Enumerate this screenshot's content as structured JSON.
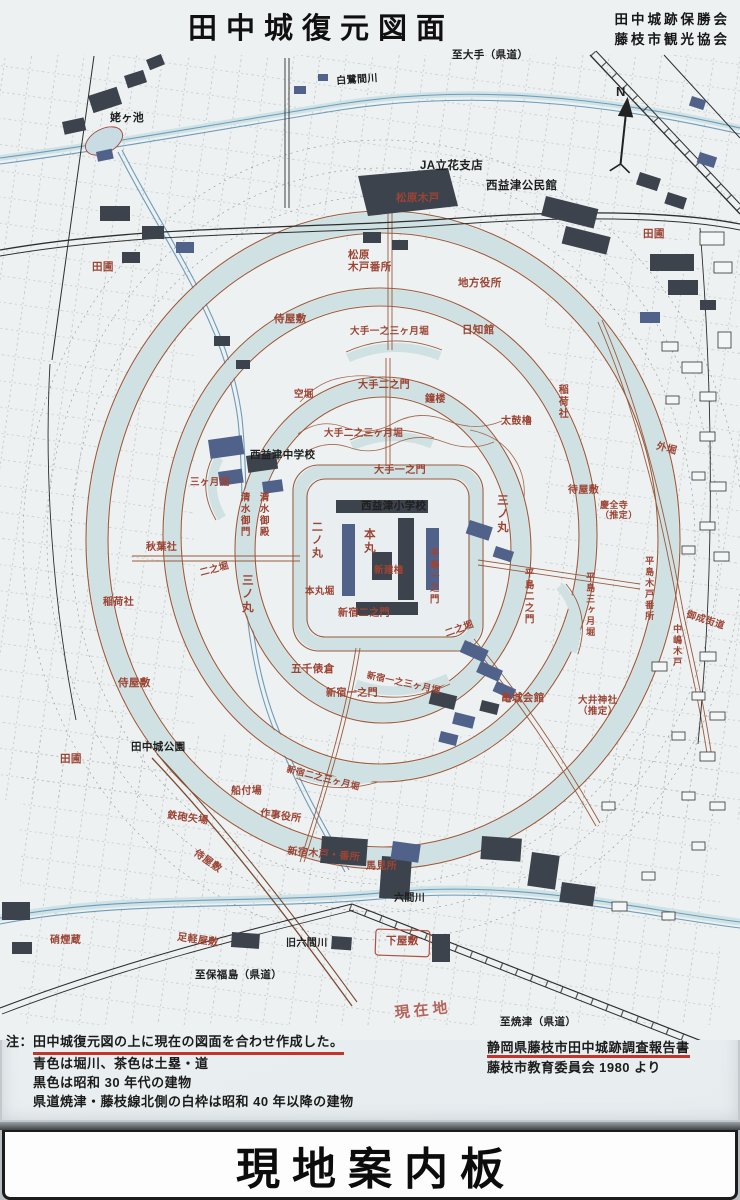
{
  "header": {
    "title": "田中城復元図面",
    "org1": "田中城跡保勝会",
    "org2": "藤枝市観光協会"
  },
  "compass": {
    "label": "N"
  },
  "palette": {
    "sign_background": "#edf1f2",
    "moat_water": "#cfe1e2",
    "earthwork_road_brown": "#9b5a3c",
    "red_label": "#9c4434",
    "black_label": "#1e1e1e",
    "building_dark": "#3d434c",
    "building_navy": "#51628a",
    "red_underline": "#c3342a",
    "handwriting_red": "#b0574c"
  },
  "map": {
    "labels": [
      {
        "t": "姥ヶ池",
        "x": 110,
        "y": 112,
        "c": "k",
        "s": 11
      },
      {
        "t": "白鷺間川",
        "x": 336,
        "y": 76,
        "c": "k",
        "s": 10,
        "r": -4
      },
      {
        "t": "至大手（県道）",
        "x": 452,
        "y": 50,
        "c": "k",
        "s": 10.5
      },
      {
        "t": "JA立花支店",
        "x": 420,
        "y": 160,
        "c": "k",
        "s": 11.5
      },
      {
        "t": "西益津公民館",
        "x": 486,
        "y": 180,
        "c": "k",
        "s": 11.5
      },
      {
        "t": "松原木戸",
        "x": 396,
        "y": 193,
        "c": "r",
        "s": 10.5
      },
      {
        "t": "松原\n木戸番所",
        "x": 348,
        "y": 250,
        "c": "r",
        "s": 10.5
      },
      {
        "t": "地方役所",
        "x": 458,
        "y": 278,
        "c": "r",
        "s": 10.5
      },
      {
        "t": "日知館",
        "x": 462,
        "y": 325,
        "c": "r",
        "s": 10.5
      },
      {
        "t": "侍屋敷",
        "x": 274,
        "y": 314,
        "c": "r",
        "s": 10.5
      },
      {
        "t": "田圃",
        "x": 92,
        "y": 262,
        "c": "r",
        "s": 10.5
      },
      {
        "t": "田圃",
        "x": 643,
        "y": 229,
        "c": "r",
        "s": 10.5
      },
      {
        "t": "大手一之三ヶ月堀",
        "x": 350,
        "y": 327,
        "c": "r",
        "s": 9.5
      },
      {
        "t": "空堀",
        "x": 294,
        "y": 390,
        "c": "r",
        "s": 9.5
      },
      {
        "t": "大手二之門",
        "x": 358,
        "y": 380,
        "c": "r",
        "s": 10
      },
      {
        "t": "鐘楼",
        "x": 425,
        "y": 394,
        "c": "r",
        "s": 10
      },
      {
        "t": "大手二之三ヶ月堀",
        "x": 324,
        "y": 429,
        "c": "r",
        "s": 9.5
      },
      {
        "t": "大手一之門",
        "x": 374,
        "y": 465,
        "c": "r",
        "s": 10
      },
      {
        "t": "稲荷社",
        "x": 556,
        "y": 384,
        "c": "r",
        "s": 10,
        "v": 1
      },
      {
        "t": "太鼓櫓",
        "x": 501,
        "y": 416,
        "c": "r",
        "s": 10
      },
      {
        "t": "外堀",
        "x": 658,
        "y": 441,
        "c": "r",
        "s": 10,
        "r": 15
      },
      {
        "t": "三ヶ月堀",
        "x": 190,
        "y": 478,
        "c": "r",
        "s": 9.5
      },
      {
        "t": "清水御門",
        "x": 238,
        "y": 492,
        "c": "r",
        "s": 9.5,
        "v": 1
      },
      {
        "t": "清水御殿",
        "x": 257,
        "y": 492,
        "c": "r",
        "s": 9.5,
        "v": 1
      },
      {
        "t": "西益津中学校",
        "x": 250,
        "y": 450,
        "c": "k",
        "s": 10.5
      },
      {
        "t": "西益津小学校",
        "x": 361,
        "y": 501,
        "c": "k",
        "s": 10.5
      },
      {
        "t": "三ノ丸",
        "x": 495,
        "y": 494,
        "c": "r",
        "s": 11.5,
        "v": 1
      },
      {
        "t": "二ノ丸",
        "x": 310,
        "y": 521,
        "c": "r",
        "s": 11,
        "v": 1
      },
      {
        "t": "本丸",
        "x": 362,
        "y": 528,
        "c": "r",
        "s": 11.5,
        "v": 1
      },
      {
        "t": "新建櫓",
        "x": 374,
        "y": 566,
        "c": "r",
        "s": 9.5
      },
      {
        "t": "待屋敷",
        "x": 568,
        "y": 485,
        "c": "r",
        "s": 10
      },
      {
        "t": "慶全寺\n（推定）",
        "x": 600,
        "y": 500,
        "c": "r",
        "s": 9
      },
      {
        "t": "平島一之門",
        "x": 427,
        "y": 548,
        "c": "r",
        "s": 9.5,
        "v": 1
      },
      {
        "t": "平島二之門",
        "x": 522,
        "y": 568,
        "c": "r",
        "s": 9.5,
        "v": 1
      },
      {
        "t": "平島三ヶ月堀",
        "x": 585,
        "y": 572,
        "c": "r",
        "s": 9,
        "v": 1
      },
      {
        "t": "平島木戸番所",
        "x": 644,
        "y": 556,
        "c": "r",
        "s": 9,
        "v": 1
      },
      {
        "t": "中嶋木戸",
        "x": 672,
        "y": 624,
        "c": "r",
        "s": 9,
        "v": 1
      },
      {
        "t": "御成街道",
        "x": 688,
        "y": 610,
        "c": "r",
        "s": 9.5,
        "r": 18
      },
      {
        "t": "秋葉社",
        "x": 146,
        "y": 542,
        "c": "r",
        "s": 10
      },
      {
        "t": "二之堀",
        "x": 199,
        "y": 569,
        "c": "r",
        "s": 9.5,
        "r": -15
      },
      {
        "t": "三ノ丸",
        "x": 240,
        "y": 574,
        "c": "r",
        "s": 11.5,
        "v": 1
      },
      {
        "t": "稲荷社",
        "x": 103,
        "y": 597,
        "c": "r",
        "s": 10
      },
      {
        "t": "本丸堀",
        "x": 305,
        "y": 587,
        "c": "r",
        "s": 9.5
      },
      {
        "t": "新宿二之門",
        "x": 338,
        "y": 608,
        "c": "r",
        "s": 10
      },
      {
        "t": "二之堀",
        "x": 444,
        "y": 630,
        "c": "r",
        "s": 9.5,
        "r": -20
      },
      {
        "t": "五千俵倉",
        "x": 291,
        "y": 664,
        "c": "r",
        "s": 10.5
      },
      {
        "t": "新宿一之三ヶ月堀",
        "x": 368,
        "y": 670,
        "c": "r",
        "s": 9,
        "r": 12
      },
      {
        "t": "新宿一之門",
        "x": 326,
        "y": 688,
        "c": "r",
        "s": 10
      },
      {
        "t": "亀城会館",
        "x": 501,
        "y": 693,
        "c": "r",
        "s": 10.5
      },
      {
        "t": "大井神社\n（推定）",
        "x": 578,
        "y": 696,
        "c": "r",
        "s": 9.5
      },
      {
        "t": "侍屋敷",
        "x": 118,
        "y": 678,
        "c": "r",
        "s": 10.5
      },
      {
        "t": "田圃",
        "x": 60,
        "y": 754,
        "c": "r",
        "s": 10.5
      },
      {
        "t": "田中城公園",
        "x": 131,
        "y": 742,
        "c": "k",
        "s": 10.5
      },
      {
        "t": "新宿二之三ヶ月堀",
        "x": 288,
        "y": 764,
        "c": "r",
        "s": 9,
        "r": 14
      },
      {
        "t": "船付場",
        "x": 231,
        "y": 786,
        "c": "r",
        "s": 10
      },
      {
        "t": "作事役所",
        "x": 261,
        "y": 808,
        "c": "r",
        "s": 10,
        "r": 8
      },
      {
        "t": "鉄砲矢場",
        "x": 168,
        "y": 810,
        "c": "r",
        "s": 10,
        "r": 8
      },
      {
        "t": "新宿木戸・番所",
        "x": 288,
        "y": 846,
        "c": "r",
        "s": 10,
        "r": 5
      },
      {
        "t": "馬見所",
        "x": 366,
        "y": 861,
        "c": "r",
        "s": 10
      },
      {
        "t": "侍屋敷",
        "x": 198,
        "y": 848,
        "c": "r",
        "s": 10,
        "r": 35
      },
      {
        "t": "足軽屋敷",
        "x": 178,
        "y": 932,
        "c": "r",
        "s": 10,
        "r": 8
      },
      {
        "t": "下屋敷",
        "x": 386,
        "y": 936,
        "c": "r",
        "s": 10.5
      },
      {
        "t": "硝煙蔵",
        "x": 50,
        "y": 935,
        "c": "r",
        "s": 10
      },
      {
        "t": "六間川",
        "x": 394,
        "y": 893,
        "c": "k",
        "s": 10
      },
      {
        "t": "旧六間川",
        "x": 286,
        "y": 938,
        "c": "k",
        "s": 10
      },
      {
        "t": "至保福島（県道）",
        "x": 195,
        "y": 970,
        "c": "k",
        "s": 10.5
      },
      {
        "t": "至焼津（県道）",
        "x": 500,
        "y": 1017,
        "c": "k",
        "s": 10.5
      },
      {
        "t": "現在地",
        "x": 394,
        "y": 1006,
        "c": "h",
        "s": 15,
        "r": -6
      }
    ]
  },
  "notes": {
    "prefix": "注：",
    "line1": "田中城復元図の上に現在の図面を合わせ作成した。",
    "line2": "青色は堀川、茶色は土塁・道",
    "line3": "黒色は昭和 30 年代の建物",
    "line4": "県道焼津・藤枝線北側の白枠は昭和 40 年以降の建物"
  },
  "source": {
    "line1": "静岡県藤枝市田中城跡調査報告書",
    "line2": "藤枝市教育委員会 1980 より"
  },
  "footer": {
    "title": "現地案内板"
  }
}
